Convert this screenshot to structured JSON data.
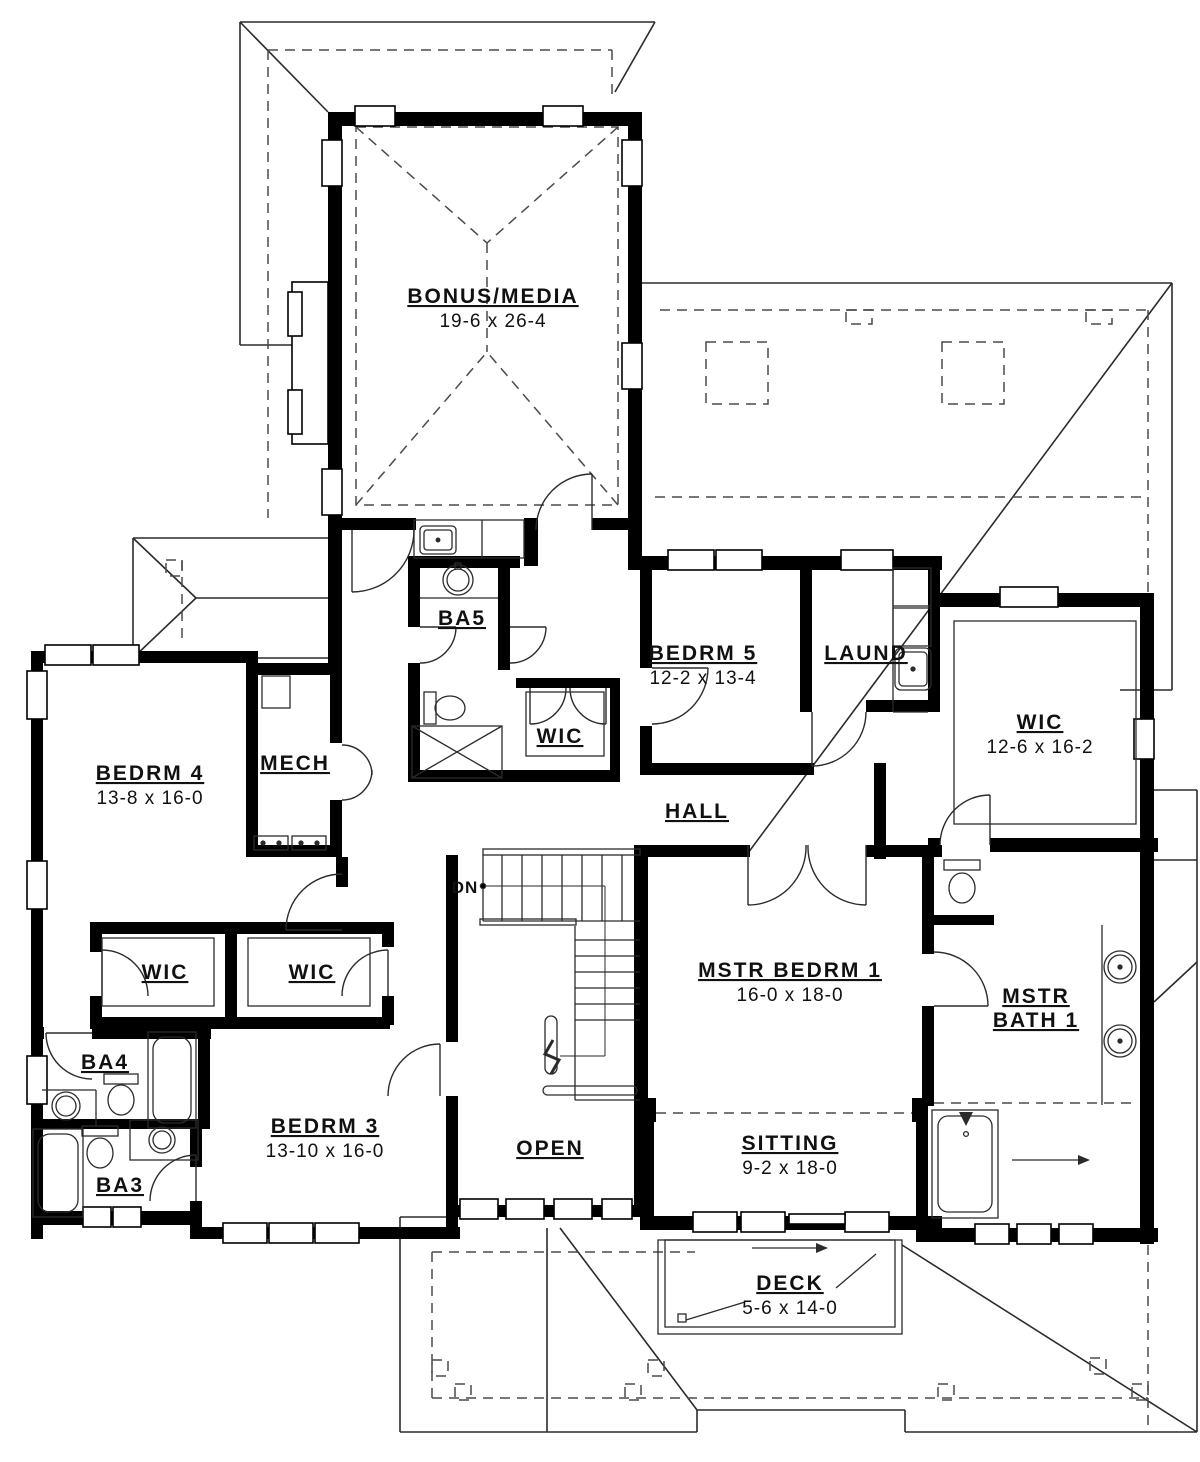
{
  "drawing": {
    "type": "second-floor-plan",
    "colors": {
      "walls": "#000000",
      "lines": "#2b2b2b",
      "background": "#ffffff"
    },
    "labels": {
      "bonus_name": "BONUS/MEDIA",
      "bonus_dims": "19-6 x 26-4",
      "ba5": "BA5",
      "wic_small": "WIC",
      "bedrm5_name": "BEDRM 5",
      "bedrm5_dims": "12-2 x 13-4",
      "laund": "LAUND",
      "wic_master_name": "WIC",
      "wic_master_dims": "12-6 x 16-2",
      "bedrm4_name": "BEDRM 4",
      "bedrm4_dims": "13-8 x 16-0",
      "mech": "MECH",
      "hall": "HALL",
      "dn": "DN",
      "mstr_bedrm_name": "MSTR BEDRM 1",
      "mstr_bedrm_dims": "16-0 x 18-0",
      "mstr_bath_line1": "MSTR",
      "mstr_bath_line2": "BATH 1",
      "wic_left": "WIC",
      "wic_mid": "WIC",
      "ba4": "BA4",
      "ba3": "BA3",
      "bedrm3_name": "BEDRM 3",
      "bedrm3_dims": "13-10 x 16-0",
      "open": "OPEN",
      "sitting_name": "SITTING",
      "sitting_dims": "9-2 x 18-0",
      "deck_name": "DECK",
      "deck_dims": "5-6 x 14-0"
    }
  }
}
